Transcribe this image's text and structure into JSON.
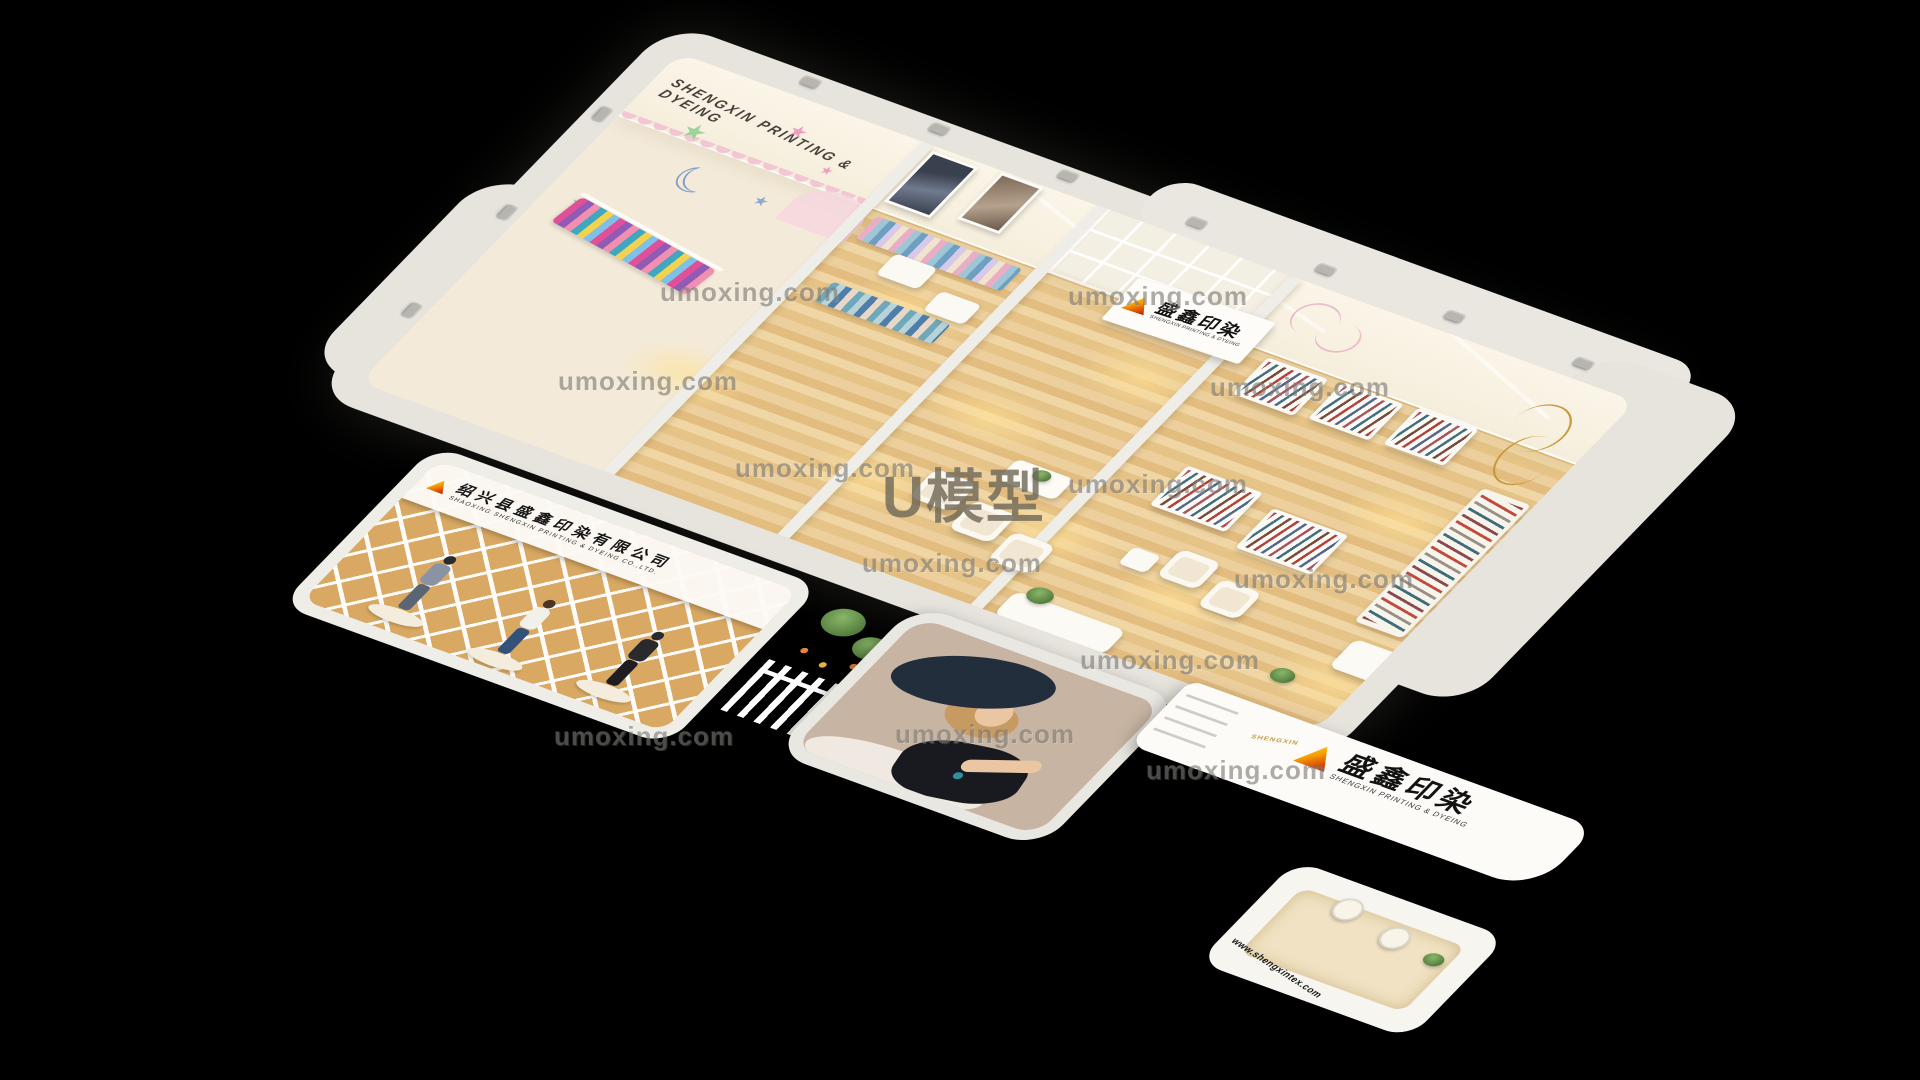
{
  "branding": {
    "wall_text": "SHENGXIN  PRINTING  &  DYEING",
    "logo_cn": "盛鑫印染",
    "logo_en": "SHENGXIN PRINTING & DYEING",
    "logo_mark": "SHENGXIN",
    "storefront_sign_cn": "绍兴县盛鑫印染有限公司",
    "storefront_sign_en": "SHAOXING SHENGXIN PRINTING & DYEING CO.,LTD.",
    "website": "www.shengxintex.com"
  },
  "watermarks": {
    "site": "umoxing.com",
    "model_mark": "U模型"
  },
  "icons": {
    "logo": "triangle-gradient",
    "stars": "star",
    "moon": "crescent-moon",
    "spotlights": "track-light"
  },
  "colors": {
    "background": "#000000",
    "outer_wall": "#e7e4dd",
    "inner_wall": "#f8f1e3",
    "wood_floor": "#e7c186",
    "cream_floor": "#f3ead9",
    "lattice_wall": "#d9a963",
    "logo_orange": "#f7a600",
    "logo_red": "#b31f00",
    "scallop_pink": "#f2c6d3",
    "star_green": "#9ed39b",
    "star_pink": "#ef9ec0",
    "moon_blue": "#7f9fca",
    "watermark_gray": "#7e7b76"
  }
}
